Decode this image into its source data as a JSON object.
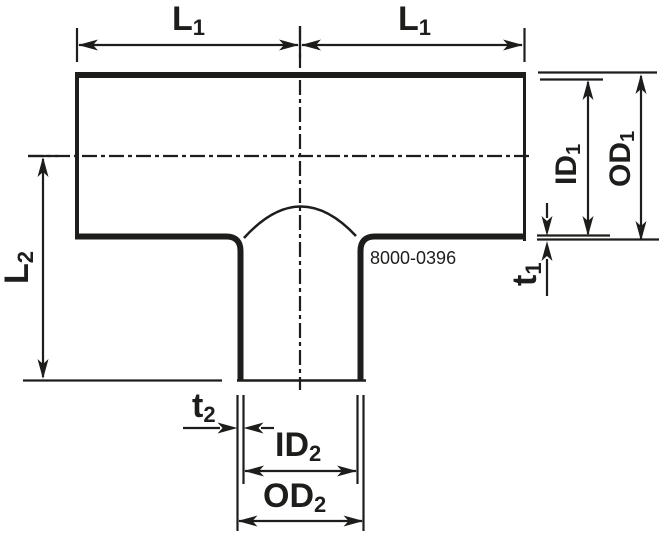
{
  "drawing": {
    "type": "tee-fitting-dimension-diagram",
    "part_number": "8000-0396",
    "labels": {
      "l1_left": {
        "base": "L",
        "sub": "1"
      },
      "l1_right": {
        "base": "L",
        "sub": "1"
      },
      "l2": {
        "base": "L",
        "sub": "2"
      },
      "id1": {
        "base": "ID",
        "sub": "1"
      },
      "od1": {
        "base": "OD",
        "sub": "1"
      },
      "t1": {
        "base": "t",
        "sub": "1"
      },
      "t2": {
        "base": "t",
        "sub": "2"
      },
      "id2": {
        "base": "ID",
        "sub": "2"
      },
      "od2": {
        "base": "OD",
        "sub": "2"
      }
    },
    "colors": {
      "ink": "#1d1d1b",
      "background": "#ffffff"
    }
  }
}
